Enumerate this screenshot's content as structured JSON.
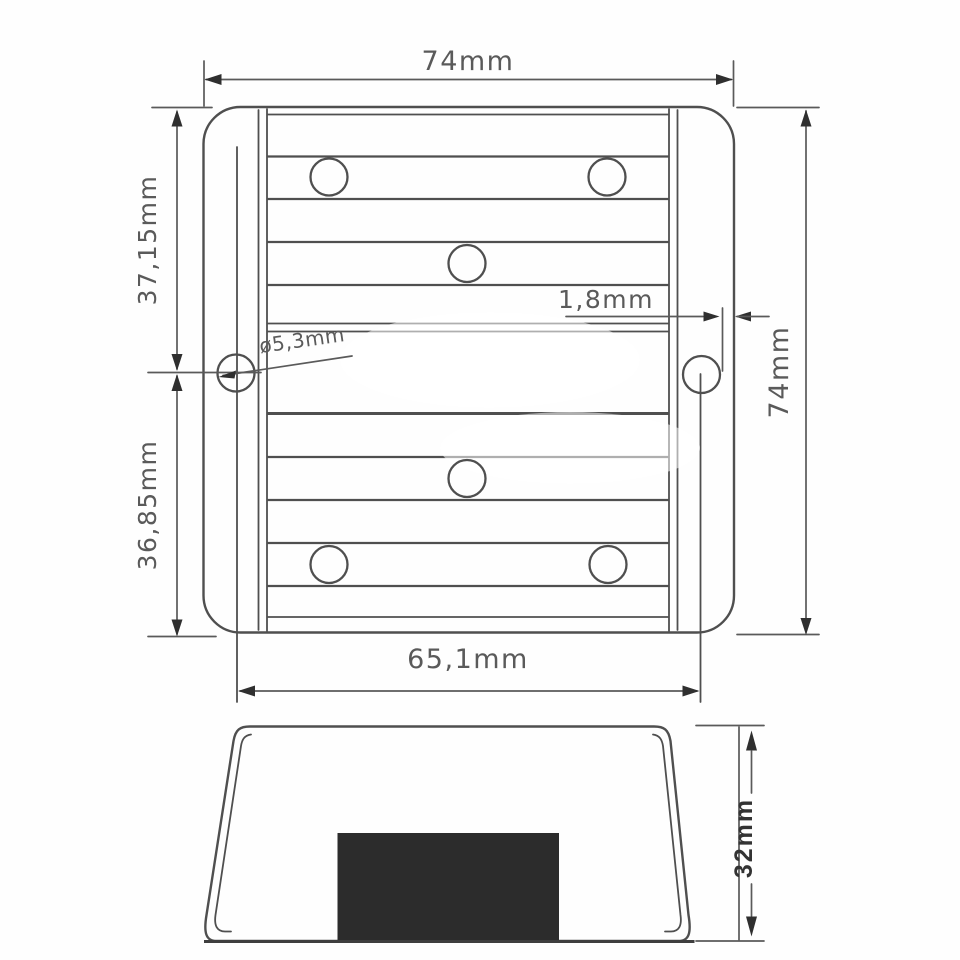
{
  "drawing": {
    "type": "technical-drawing",
    "views": {
      "top": {
        "dimensions": {
          "overall_width": "74mm",
          "overall_height": "74mm",
          "upper_section_height": "37,15mm",
          "lower_section_height": "36,85mm",
          "hole_spacing_width": "65,1mm",
          "wall_thickness": "1,8mm",
          "hole_diameter": "ø5,3mm"
        },
        "hole_count": 8
      },
      "side": {
        "dimensions": {
          "overall_height": "32mm"
        }
      }
    },
    "colors": {
      "background": "#fefefe",
      "line": "#4f4f4f",
      "dim_line": "#5a5a5a",
      "text": "#5a5a5a",
      "bold_text": "#333333",
      "block_fill": "#2c2c2c"
    }
  }
}
